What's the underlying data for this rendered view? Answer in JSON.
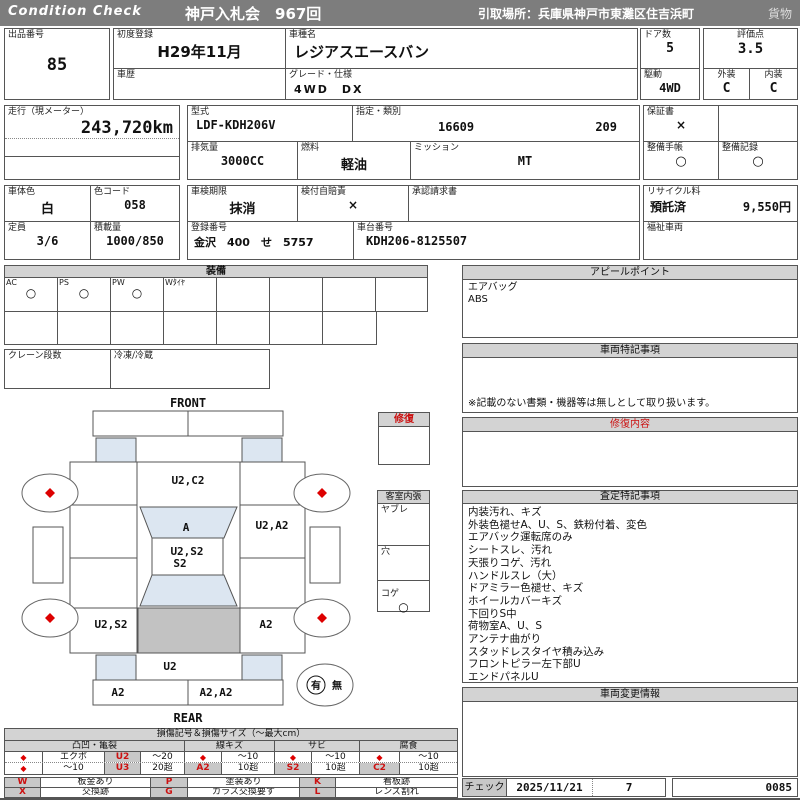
{
  "colors": {
    "header_bg": "#7d7d7d",
    "accent_red": "#cc1111",
    "label_blue": "#0000cc",
    "diagram_blue": "#dce6f1",
    "diagram_gray": "#c2c2c2",
    "code_cell_bg": "#c8c8c8"
  },
  "header": {
    "brand": "Condition  Check",
    "auction": "神戸入札会　967回",
    "pickup": "引取場所：兵庫県神戸市東灘区住吉浜町",
    "cargo": "貨物"
  },
  "info": {
    "lot_label": "出品番号",
    "lot_no": "85",
    "first_reg_label": "初度登録",
    "first_reg": "H29年11月",
    "history_label": "車歴",
    "history": "",
    "model_name_label": "車種名",
    "model_name": "レジアスエースバン",
    "grade_label": "グレード・仕様",
    "grade": "4WD　DX",
    "doors_label": "ドア数",
    "doors": "5",
    "drive_label": "駆動",
    "drive": "4WD",
    "score_label": "評価点",
    "score": "3.5",
    "exterior_label": "外装",
    "exterior": "C",
    "interior_label": "内装",
    "interior": "C",
    "mileage_label": "走行（現メーター）",
    "mileage": "243,720km",
    "model_code_label": "型式",
    "model_code": "LDF-KDH206V",
    "type_class_label": "指定・類別",
    "type_no": "16609",
    "class_no": "209",
    "displacement_label": "排気量",
    "displacement": "3000CC",
    "fuel_label": "燃料",
    "fuel": "軽油",
    "mission_label": "ミッション",
    "mission": "MT",
    "warranty_label": "保証書",
    "warranty": "×",
    "book_label": "整備手帳",
    "book": "○",
    "record_label": "整備記録",
    "record": "○",
    "body_color_label": "車体色",
    "body_color": "白",
    "color_code_label": "色コード",
    "color_code": "058",
    "inspection_label": "車検期限",
    "inspection": "抹消",
    "jibaiseki_label": "検付自賠責",
    "jibaiseki": "×",
    "approval_label": "承認請求書",
    "approval": "",
    "recycle_label": "リサイクル料",
    "recycle_status": "預託済",
    "recycle_fee": "9,550円",
    "capacity_label": "定員",
    "capacity": "3/6",
    "load_label": "積載量",
    "load": "1000/850",
    "reg_label": "登録番号",
    "reg_no": "金沢　400　せ　5757",
    "chassis_label": "車台番号",
    "chassis": "KDH206-8125507",
    "welfare_label": "福祉車両",
    "welfare": ""
  },
  "equipment": {
    "title": "装備",
    "items": [
      {
        "label": "AC",
        "value": "○"
      },
      {
        "label": "PS",
        "value": "○"
      },
      {
        "label": "PW",
        "value": "○"
      },
      {
        "label": "Wﾀｲﾔ",
        "value": ""
      },
      {
        "label": "",
        "value": ""
      },
      {
        "label": "",
        "value": ""
      },
      {
        "label": "",
        "value": ""
      },
      {
        "label": "",
        "value": ""
      }
    ],
    "crane_label": "クレーン段数",
    "crane": "",
    "freezer_label": "冷凍/冷蔵",
    "freezer": ""
  },
  "diagram": {
    "front_label": "FRONT",
    "rear_label": "REAR",
    "marks": {
      "front_center": "U2,C2",
      "windshield": "A",
      "roof_a": "U2,S2",
      "roof_b": "S2",
      "right_mid": "U2,A2",
      "left_rear": "U2,S2",
      "right_rear": "A2",
      "tailgate": "U2",
      "rear_bumper_left": "A2",
      "rear_bumper_right": "A2,A2"
    },
    "presence_yes": "有",
    "presence_no": "無"
  },
  "repair": {
    "title": "修復"
  },
  "cabin": {
    "title": "客室内張",
    "rows": [
      {
        "label": "ヤブレ",
        "value": ""
      },
      {
        "label": "穴",
        "value": ""
      },
      {
        "label": "コゲ",
        "value": "○"
      }
    ]
  },
  "panels": {
    "appeal": {
      "title": "アピールポイント",
      "lines": [
        "エアバッグ",
        "ABS"
      ]
    },
    "vehicle_notes": {
      "title": "車両特記事項",
      "note": "※記載のない書類・機器等は無しとして取り扱います。"
    },
    "repair_detail": {
      "title": "修復内容"
    },
    "assessment": {
      "title": "査定特記事項",
      "lines": [
        "内装汚れ、キズ",
        "外装色褪せA、U、S、鉄粉付着、変色",
        "エアバック運転席のみ",
        "シートスレ、汚れ",
        "天張りコゲ、汚れ",
        "ハンドルスレ（大）",
        "ドアミラー色褪せ、キズ",
        "ホイールカバーキズ",
        "下回りS中",
        "荷物室A、U、S",
        "アンテナ曲がり",
        "スタッドレスタイヤ積み込み",
        "フロントピラー左下部U",
        "エンドパネルU"
      ]
    },
    "change_info": {
      "title": "車両変更情報"
    }
  },
  "legend": {
    "title": "損傷記号＆損傷サイズ（～最大cm）",
    "groups": [
      "凸凹・亀裂",
      "線キズ",
      "サビ",
      "腐食"
    ],
    "diamond": "◆",
    "dent_r1": [
      "エクボ",
      "U2",
      "～20"
    ],
    "dent_r2": [
      "～10",
      "U3",
      "20超"
    ],
    "scratch": {
      "size1": "～10",
      "code": "A2",
      "size2": "10超"
    },
    "rust": {
      "size1": "～10",
      "code": "S2",
      "size2": "10超"
    },
    "corrosion": {
      "size1": "～10",
      "code": "C2",
      "size2": "10超"
    },
    "codes": [
      {
        "k": "W",
        "v": "板金あり"
      },
      {
        "k": "P",
        "v": "塗装あり"
      },
      {
        "k": "K",
        "v": "看板跡"
      },
      {
        "k": "X",
        "v": "交換跡"
      },
      {
        "k": "G",
        "v": "ガラス交換要す"
      },
      {
        "k": "L",
        "v": "レンズ割れ"
      }
    ]
  },
  "footer": {
    "check_label": "チェック",
    "date": "2025/11/21",
    "number": "7",
    "serial": "0085"
  }
}
